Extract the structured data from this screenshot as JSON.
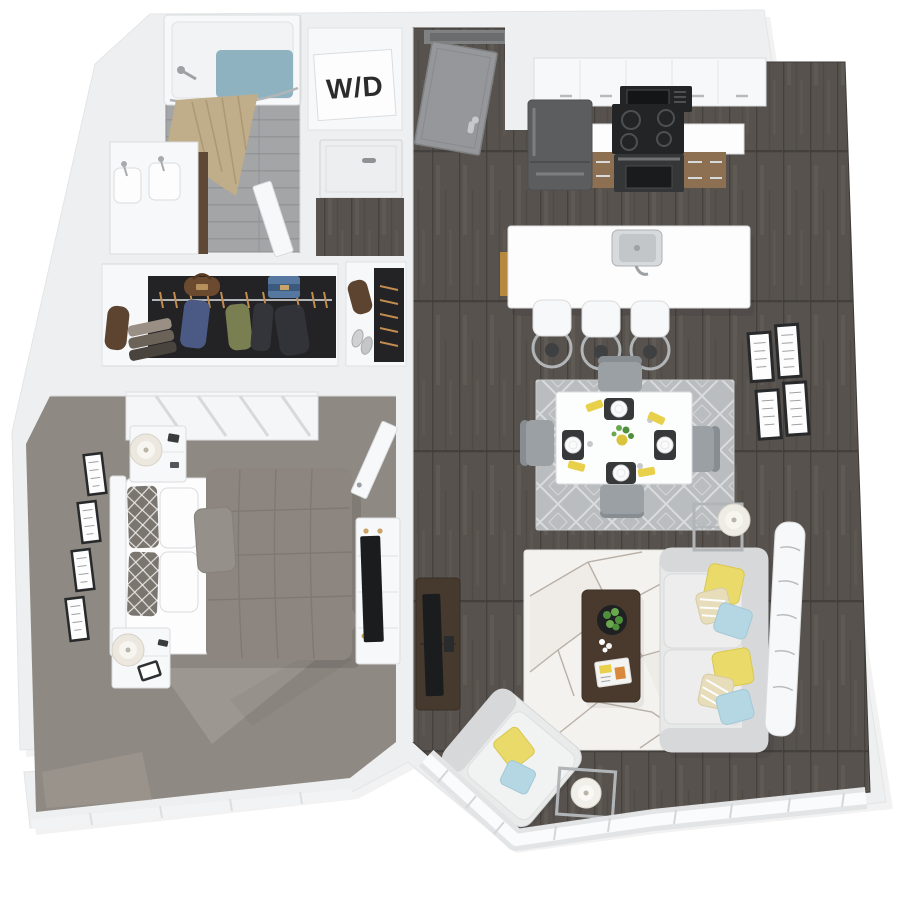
{
  "labels": {
    "washer_dryer": "W/D"
  },
  "colors": {
    "wall": "#edeff0",
    "wall-bright": "#f7f8f9",
    "wall-edge": "#dadcde",
    "pure-white": "#fdfdfe",
    "wood": "#57524e",
    "wood-gap": "#45413d",
    "wood-streak": "#6a645e",
    "tile": "#a3a5a7",
    "tile-line": "#8e9092",
    "carpet": "#8f8983",
    "carpet-light": "#a9a39c",
    "closet-dark": "#232326",
    "chrome": "#b2b5b8",
    "curtain": "#c0ad89",
    "curtain-fold": "#a6926d",
    "water": "#8fb2c1",
    "vanity-wood": "#5e4936",
    "cab-wood": "#8d7052",
    "island-wood": "#b5893f",
    "fridge": "#5b5d5f",
    "appliance-black": "#232426",
    "oven": "#353638",
    "sofa": "#e7e8e8",
    "sofa-dark": "#d7d8d9",
    "pillow-yellow": "#e9da6a",
    "pillow-blue": "#b4d7e3",
    "pillow-stripe": "#e7ddba",
    "rug-living": "#f4f2ee",
    "rug-living-line": "#b9b0a7",
    "rug-dining": "#babdbf",
    "rug-dining-line": "#d9dbdc",
    "chair": "#9aa0a4",
    "chair-dark": "#878d91",
    "table-top": "#fcfdfd",
    "coffee-table": "#4a3a2e",
    "tv-console": "#463a2f",
    "black": "#1b1c1e",
    "frame": "#28292b",
    "napkin": "#e8d04b",
    "plant": "#4e8f3c",
    "plant-light": "#6aa84e",
    "door-gray": "#95979a",
    "door-frame": "#7e8082",
    "duvet": "#8d8680",
    "duvet-line": "#7d7771",
    "pillow-pattern": "#7b7570",
    "accent-pillow": "#96908a",
    "gold": "#c9a368",
    "bag-brown": "#5d4431",
    "cloth-blue": "#4a5a84",
    "cloth-green": "#7a7f52",
    "cloth-dark": "#34353b",
    "bag-blue": "#5577a0",
    "ink": "#2b2b2b"
  },
  "plan": {
    "rooms": [
      {
        "name": "bathroom",
        "furniture": [
          "bathtub",
          "shower-curtain",
          "shower-head",
          "double-vanity",
          "bathroom-door"
        ]
      },
      {
        "name": "laundry-closet",
        "label": "W/D"
      },
      {
        "name": "hall-closet",
        "furniture": [
          "closet-door"
        ]
      },
      {
        "name": "walk-in-closet",
        "furniture": [
          "hanging-clothes",
          "folded-clothes",
          "duffel-bag",
          "handbag",
          "shoes"
        ]
      },
      {
        "name": "bedroom",
        "furniture": [
          "bed",
          "headboard",
          "nightstands",
          "table-lamps",
          "wall-frames",
          "dresser",
          "tv",
          "bedroom-door",
          "window-blinds-panel"
        ]
      },
      {
        "name": "entry",
        "furniture": [
          "entry-door"
        ]
      },
      {
        "name": "kitchen",
        "furniture": [
          "refrigerator",
          "microwave",
          "range",
          "upper-cabinets",
          "base-cabinets",
          "countertop",
          "island",
          "sink",
          "bar-stools"
        ]
      },
      {
        "name": "dining-area",
        "furniture": [
          "dining-table",
          "dining-chairs",
          "diamond-rug",
          "place-settings",
          "napkins",
          "centerpiece"
        ]
      },
      {
        "name": "living-room",
        "furniture": [
          "sofa",
          "accent-pillows",
          "geometric-rug",
          "coffee-table",
          "planter-bowl",
          "magazine",
          "tv-console",
          "tv",
          "armchair",
          "floor-lamp",
          "side-table-lamp",
          "gallery-frames",
          "window-wall",
          "console-behind-sofa"
        ]
      }
    ]
  }
}
